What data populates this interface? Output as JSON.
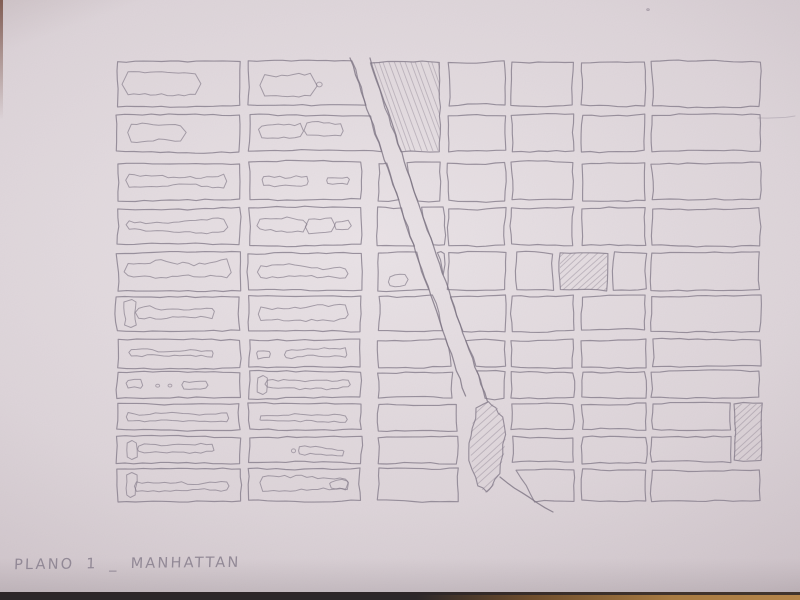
{
  "photo": {
    "caption": "PLANO 1 _ MANHATTAN",
    "colors": {
      "paper_light": "#e9e2e6",
      "paper_mid": "#dcd3d8",
      "paper_dim": "#cdc2c8",
      "paper_dark": "#b2a6ac",
      "pencil": "#837a89",
      "pencil_dark": "#7c7382",
      "pencil_soft": "#8d8492",
      "table_wood": "#a87b42",
      "table_dark": "#2c2729",
      "spine": "#6e4437"
    },
    "map": {
      "rows": [
        [
          62,
          106
        ],
        [
          115,
          151
        ],
        [
          163,
          200
        ],
        [
          208,
          245
        ],
        [
          253,
          290
        ],
        [
          296,
          331
        ],
        [
          340,
          367
        ],
        [
          372,
          398
        ],
        [
          404,
          430
        ],
        [
          437,
          463
        ],
        [
          469,
          501
        ]
      ],
      "left_cols": [
        [
          117,
          240
        ],
        [
          249,
          361
        ]
      ],
      "mid_col_left": 378,
      "mid_right_edges": [
        440,
        440,
        440,
        444,
        444,
        444,
        452,
        452,
        457,
        457,
        458
      ],
      "right_cols": [
        [
          448,
          505
        ],
        [
          512,
          573
        ],
        [
          582,
          645
        ],
        [
          652,
          760
        ]
      ],
      "right_col4_narrow_rows": [
        8,
        9
      ],
      "right_col4_narrow_right": 730,
      "diagonal": {
        "x0": 350,
        "y0": 58,
        "slope": 0.342,
        "y_end": 396,
        "street_offset": 20
      },
      "tail_street": [
        500,
        477,
        553,
        512
      ],
      "row5_small_blocks": [
        [
          518,
          553
        ],
        [
          560,
          607
        ],
        [
          614,
          646
        ]
      ],
      "row5_hatched_index": 1,
      "hatched_tall_block": [
        734,
        404,
        762,
        460
      ],
      "park_teardrop_pts": [
        [
          488,
          401
        ],
        [
          497,
          407
        ],
        [
          503,
          417
        ],
        [
          506,
          434
        ],
        [
          504,
          455
        ],
        [
          499,
          473
        ],
        [
          493,
          487
        ],
        [
          486,
          493
        ],
        [
          479,
          487
        ],
        [
          473,
          470
        ],
        [
          470,
          450
        ],
        [
          471,
          428
        ],
        [
          477,
          409
        ]
      ],
      "r2_bottom_trapezoid": [
        [
          516,
          469
        ],
        [
          573,
          469
        ],
        [
          573,
          501
        ],
        [
          534,
          501
        ]
      ],
      "m_row5_mark": [
        390,
        276,
        405,
        286
      ],
      "stray_dot": [
        648,
        10
      ],
      "stray_line": [
        758,
        118,
        795,
        116
      ],
      "hatch_dirs": {
        "avenue_block": [
          0.34,
          0.94
        ],
        "slash": [
          0.74,
          -0.67
        ]
      },
      "left_blob_styles": [
        [
          "box",
          "lump",
          "long",
          "long",
          "lumpy",
          "tee",
          "thin",
          "bits",
          "lumpy",
          "tee",
          "tee-wide"
        ],
        [
          "lump-dot",
          "pair",
          "thin-pair",
          "split2",
          "long",
          "long",
          "notch",
          "tee-wide",
          "long",
          "short-mid",
          "angular"
        ]
      ]
    }
  }
}
